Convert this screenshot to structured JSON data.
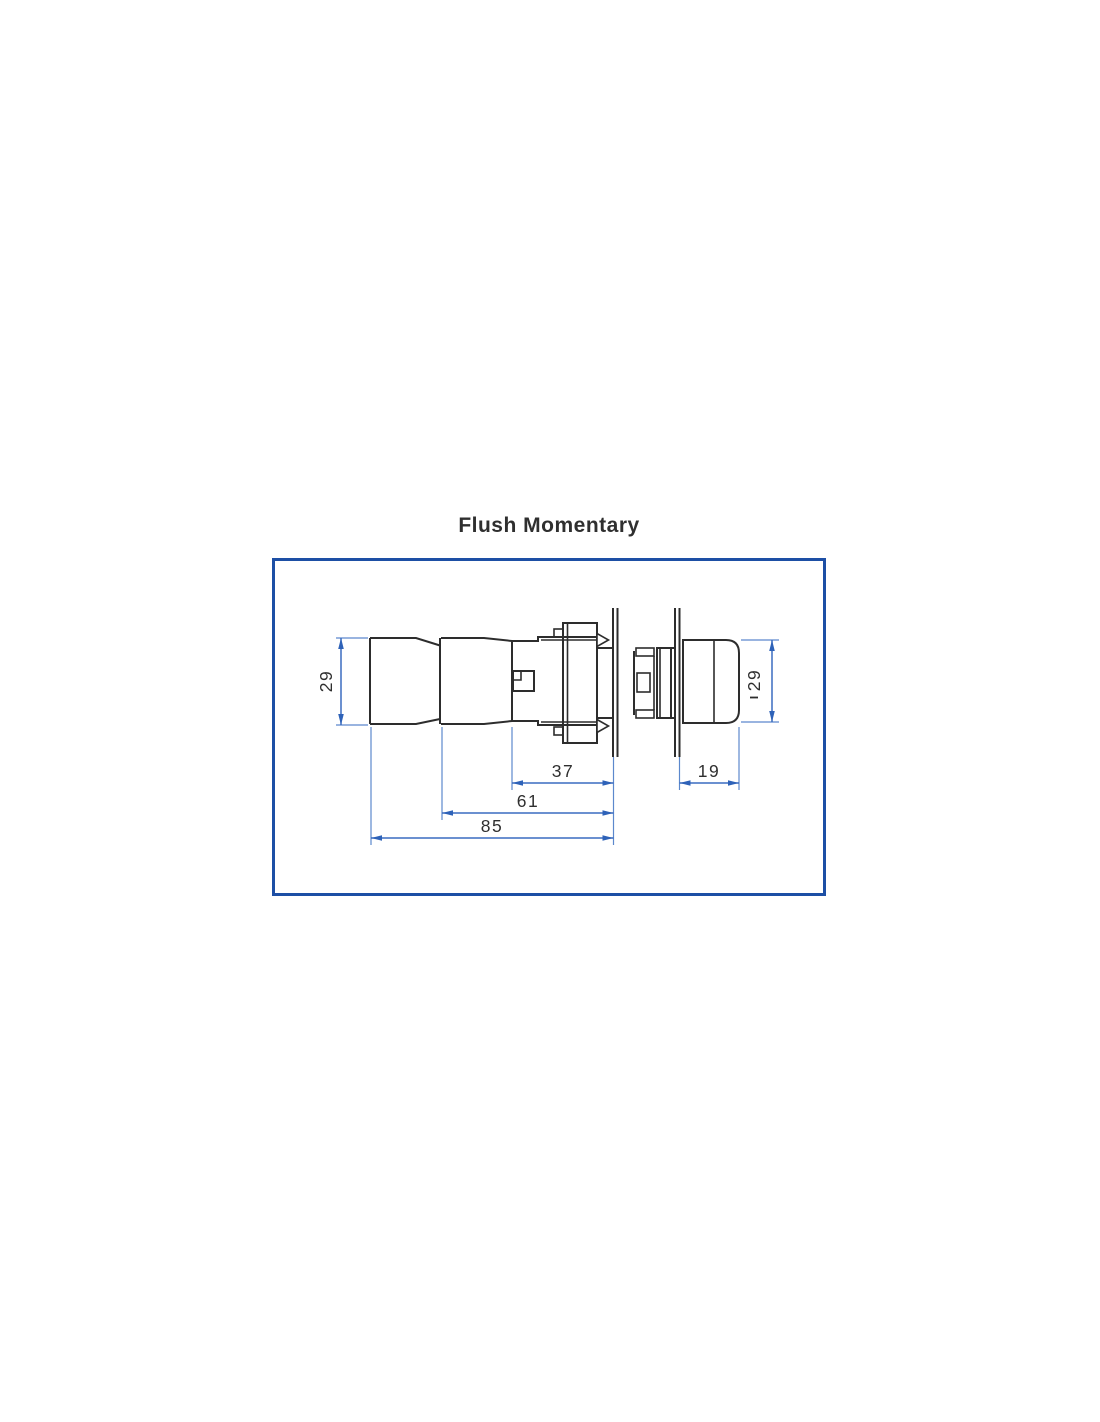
{
  "title": "Flush Momentary",
  "diagram": {
    "type": "technical-dimension-drawing",
    "subject": "flush momentary pushbutton switch, side view and head view through mounting panel",
    "dim_labels": {
      "cap_height": "29",
      "head_height": "29",
      "behind_panel_length": "37",
      "switch_unit_length": "61",
      "total_length": "85",
      "head_projection": "19"
    },
    "colors": {
      "frame_border": "#1d4fa5",
      "dimension_lines": "#3a6cc0",
      "part_outline": "#2d2d2d",
      "background": "#ffffff"
    }
  }
}
